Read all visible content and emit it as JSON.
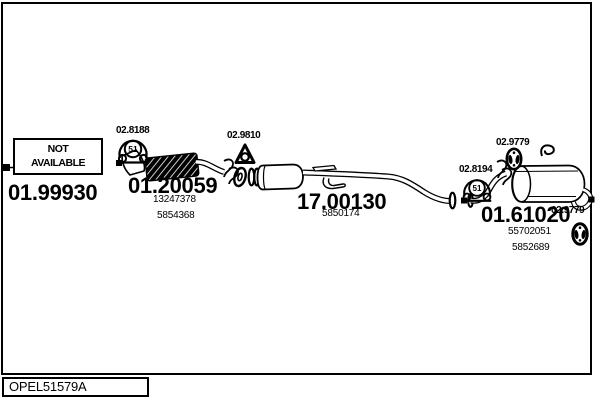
{
  "colors": {
    "line": "#000000",
    "background": "#ffffff"
  },
  "parts": {
    "not_available_part": {
      "code": "01.99930",
      "status_line1": "NOT",
      "status_line2": "AVAILABLE"
    },
    "front_pipe": {
      "code": "01.20059",
      "oem_numbers": [
        "13247378",
        "5854368"
      ]
    },
    "middle_pipe": {
      "code": "17.00130",
      "oem_numbers": [
        "5850174"
      ]
    },
    "rear_muffler": {
      "code": "01.61020",
      "oem_numbers": [
        "55702051",
        "5852689"
      ]
    }
  },
  "mounts": {
    "gasket_front": {
      "code": "02.8188",
      "symbol": "51"
    },
    "gasket_triangle": {
      "code": "02.9810"
    },
    "hanger_mid": {
      "code": "02.9779"
    },
    "gasket_rear": {
      "code": "02.8194",
      "symbol": "51"
    },
    "hanger_tail": {
      "code": "02.9779"
    }
  },
  "footer": {
    "diagram_code": "OPEL51579A"
  }
}
